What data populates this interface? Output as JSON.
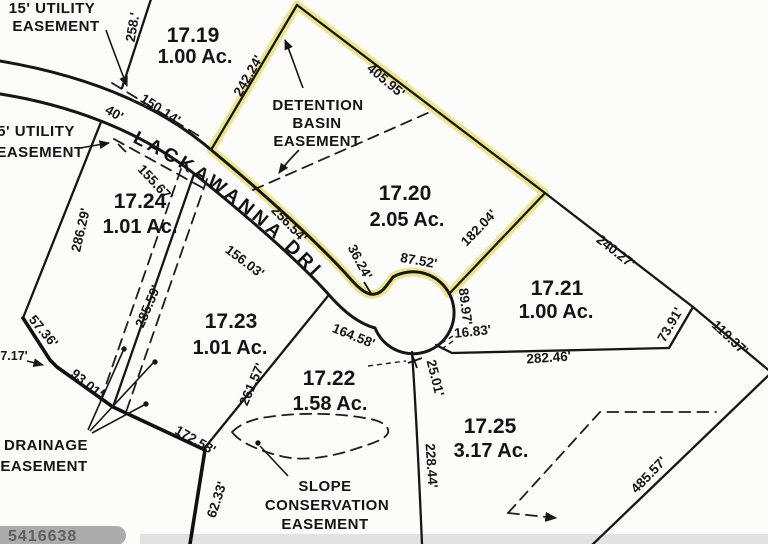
{
  "road": {
    "name": "LACKAWANNA DRIVE",
    "width": "40'"
  },
  "lots": {
    "l17_19": {
      "id": "17.19",
      "area": "1.00 Ac."
    },
    "l17_20": {
      "id": "17.20",
      "area": "2.05 Ac.",
      "highlighted": true
    },
    "l17_21": {
      "id": "17.21",
      "area": "1.00 Ac."
    },
    "l17_22": {
      "id": "17.22",
      "area": "1.58 Ac."
    },
    "l17_23": {
      "id": "17.23",
      "area": "1.01 Ac."
    },
    "l17_24": {
      "id": "17.24",
      "area": "1.01 Ac."
    },
    "l17_25": {
      "id": "17.25",
      "area": "3.17 Ac."
    }
  },
  "easements": {
    "utility15_l1": "15' UTILITY",
    "utility15_l2": "EASEMENT",
    "utility5_l1": "5' UTILITY",
    "utility5_l2": "EASEMENT",
    "detention_l1": "DETENTION",
    "detention_l2": "BASIN",
    "detention_l3": "EASEMENT",
    "drainage_l1": "DRAINAGE",
    "drainage_l2": "EASEMENT",
    "slope_l1": "SLOPE",
    "slope_l2": "CONSERVATION",
    "slope_l3": "EASEMENT"
  },
  "dimensions": {
    "d258": "258.'",
    "d150_14": "150.14'",
    "d242_24": "242.24'",
    "d405_95": "405.95'",
    "d256_54": "256.54'",
    "d155_67": "155.67'",
    "d286_29": "286.29'",
    "d156_03": "156.03'",
    "d285_59": "285.59'",
    "d36_24": "36.24'",
    "d87_52": "87.52'",
    "d182_04": "182.04'",
    "d240_27": "240.27'",
    "d89_97": "89.97'",
    "d16_83": "16.83'",
    "d73_91": "73.91'",
    "d119_37": "119.37'",
    "d282_46": "282.46'",
    "d164_58": "164.58'",
    "d25_01": "25.01'",
    "d228_44": "228.44'",
    "d261_57": "261.57'",
    "d172_58": "172.58'",
    "d62_33": "62.33'",
    "d93_01": "93.01'",
    "d57_36": "57.36'",
    "d7_17": "7.17'",
    "d485_57": "485.57'"
  },
  "watermark": "5416638",
  "colors": {
    "highlight": "#e9df6e",
    "line": "#161616",
    "paper": "#fcfcfa",
    "watermark_bar": "#acacac",
    "watermark_text": "#5f5f5f"
  }
}
